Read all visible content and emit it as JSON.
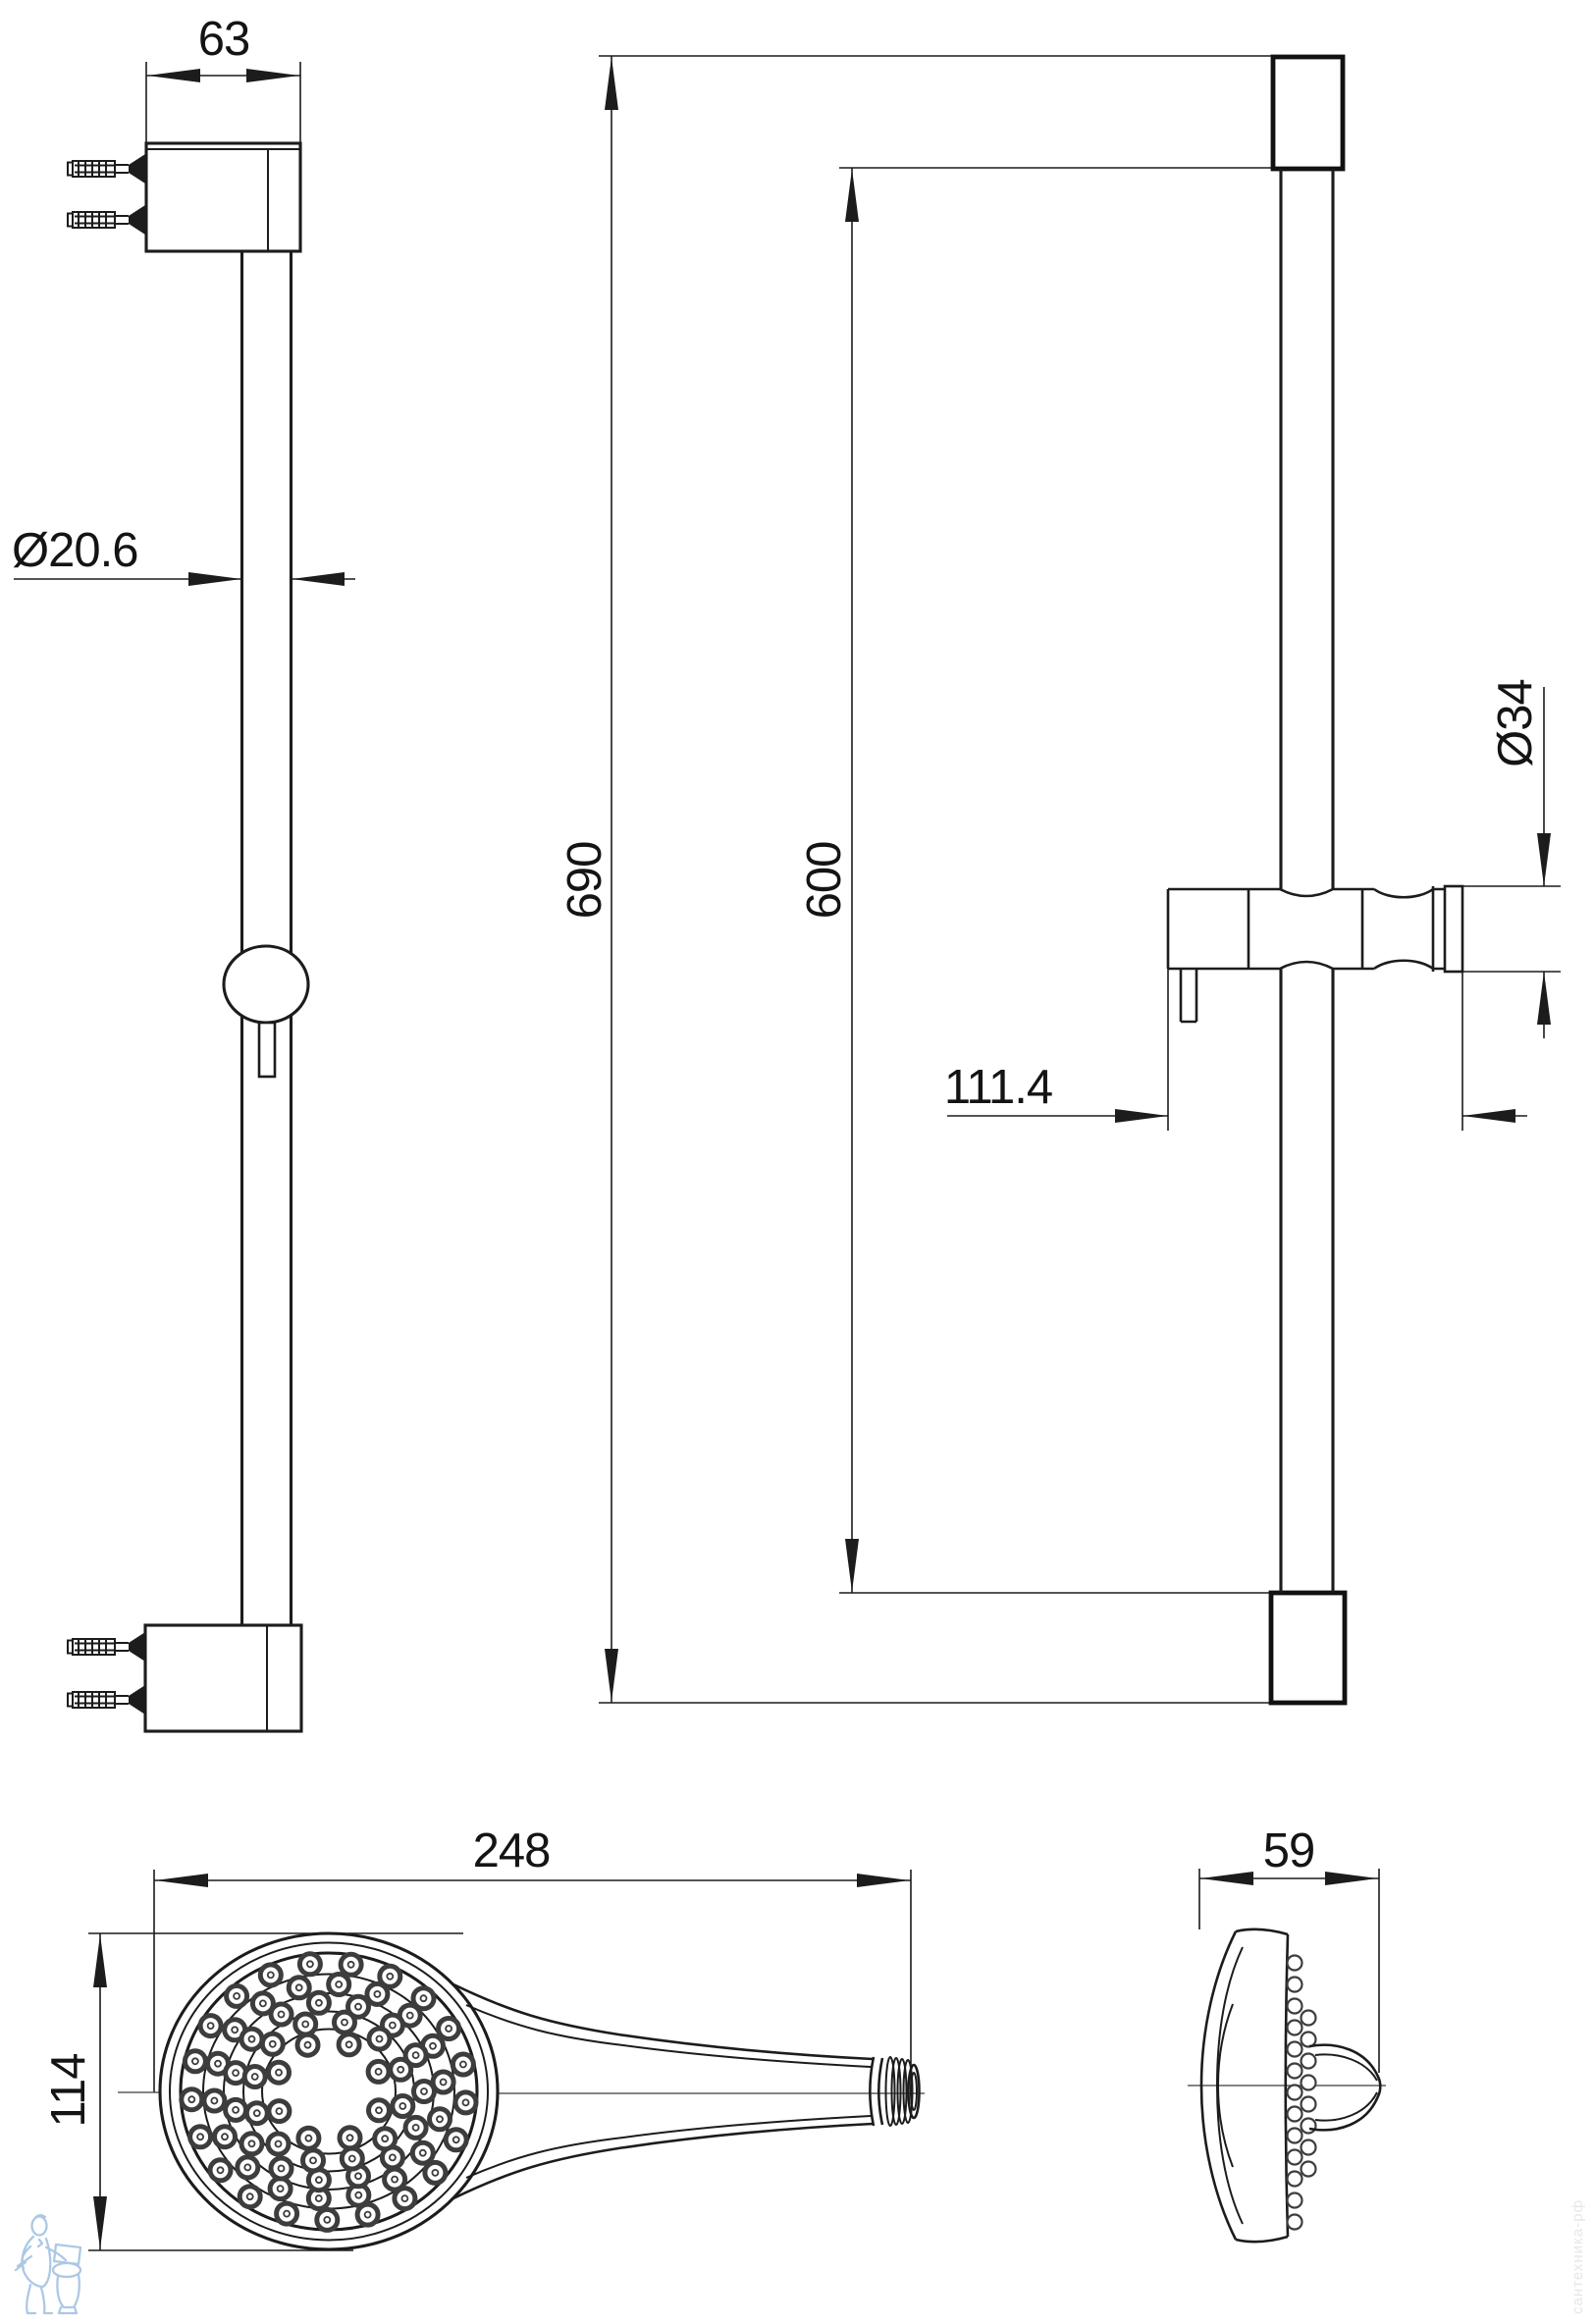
{
  "page": {
    "background": "#ffffff",
    "line_color": "#1c1c1c"
  },
  "views": {
    "rail_front": {
      "bracket_width": "63",
      "bar_diameter": "Ø20.6"
    },
    "rail_side": {
      "overall_length": "690",
      "bar_length": "600",
      "holder_diameter": "Ø34",
      "holder_depth": "111.4"
    },
    "handshower_top": {
      "length": "248",
      "head_diameter": "114"
    },
    "handshower_side": {
      "depth": "59"
    }
  },
  "watermarks": {
    "shop_name": "сантехника-рф",
    "mascot_color": "#adc8e6",
    "text_color": "#e7e7e7"
  }
}
